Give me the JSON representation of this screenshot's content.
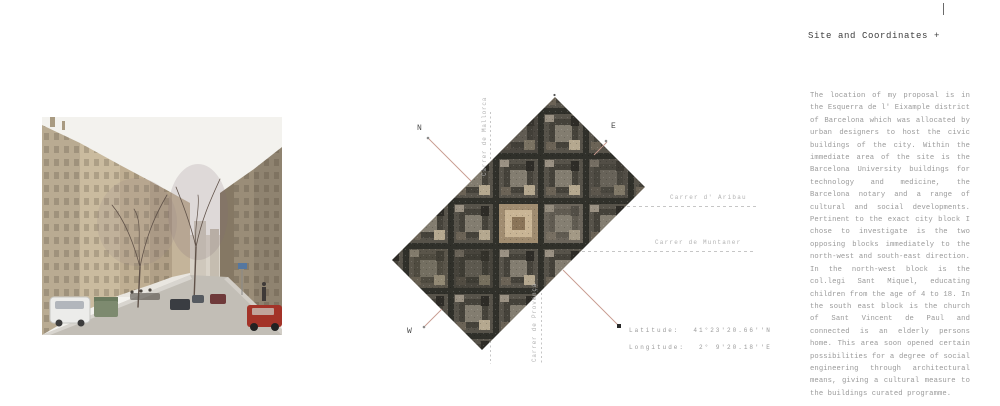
{
  "theme": {
    "accent_line": "#c79b90",
    "dashed_line": "#c6c6c6",
    "body_text": "#9a9a9a",
    "title_text": "#3c3c3c",
    "label_text": "#b3b3b3",
    "compass_text": "#4a4a4a"
  },
  "header": {
    "title": "Site and Coordinates +"
  },
  "article": {
    "body": "The location of my proposal is in the Esquerra de l' Eixample district of Barcelona which was allocated by urban designers to host the civic buildings of the city. Within the immediate area of the site is the Barcelona University buildings for technology and medicine, the Barcelona notary and a range of cultural and social developments. Pertinent to the exact city block I chose to investigate is the two opposing blocks immediately to the north-west and south-east direction. In the north-west block is the col.legi Sant Miquel, educating children from the age of 4 to 18. In the south east block is the church of Sant Vincent de Paul and connected is an elderly persons home. This area soon opened certain possibilities for a degree of social engineering through architectural means, giving a cultural measure to the buildings curated programme."
  },
  "map": {
    "compass": {
      "north": "N",
      "east": "E",
      "west": "W"
    },
    "streets": {
      "aribau": "Carrer d' Aribau",
      "muntaner": "Carrer de Muntaner",
      "mallorca": "Carrer de Mallorca",
      "provenca": "Carrer de Provença"
    },
    "coordinates": {
      "latitude_label": "Latitude:",
      "latitude_value": "41°23'20.66''N",
      "longitude_label": "Longitude:",
      "longitude_value": "2° 9'20.18''E"
    }
  },
  "photo": {
    "description": "street-photograph-eixample-barcelona"
  }
}
